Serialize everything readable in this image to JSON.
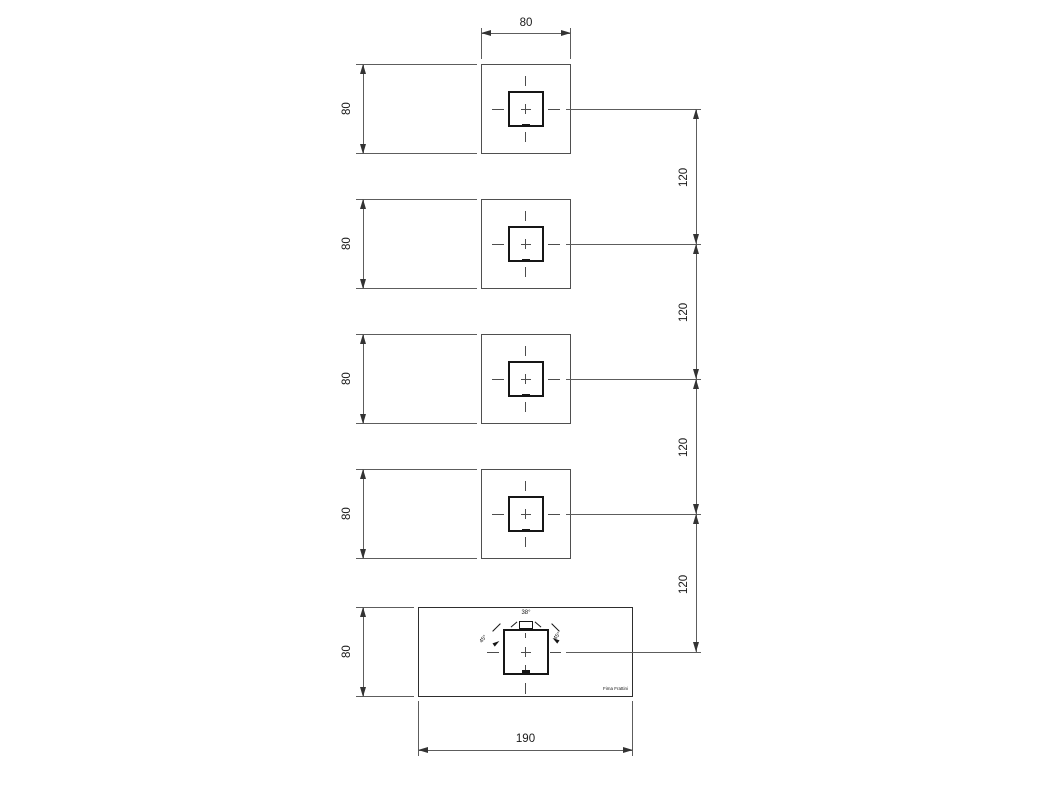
{
  "dims": {
    "top_width": "80",
    "row_heights": [
      "80",
      "80",
      "80",
      "80"
    ],
    "spacings": [
      "120",
      "120",
      "120",
      "120"
    ],
    "bottom_height": "80",
    "bottom_width": "190"
  },
  "bottom_view": {
    "angle_top": "38°",
    "angle_left": "45°",
    "angle_right": "45°",
    "brand": "Fima Frattini"
  }
}
